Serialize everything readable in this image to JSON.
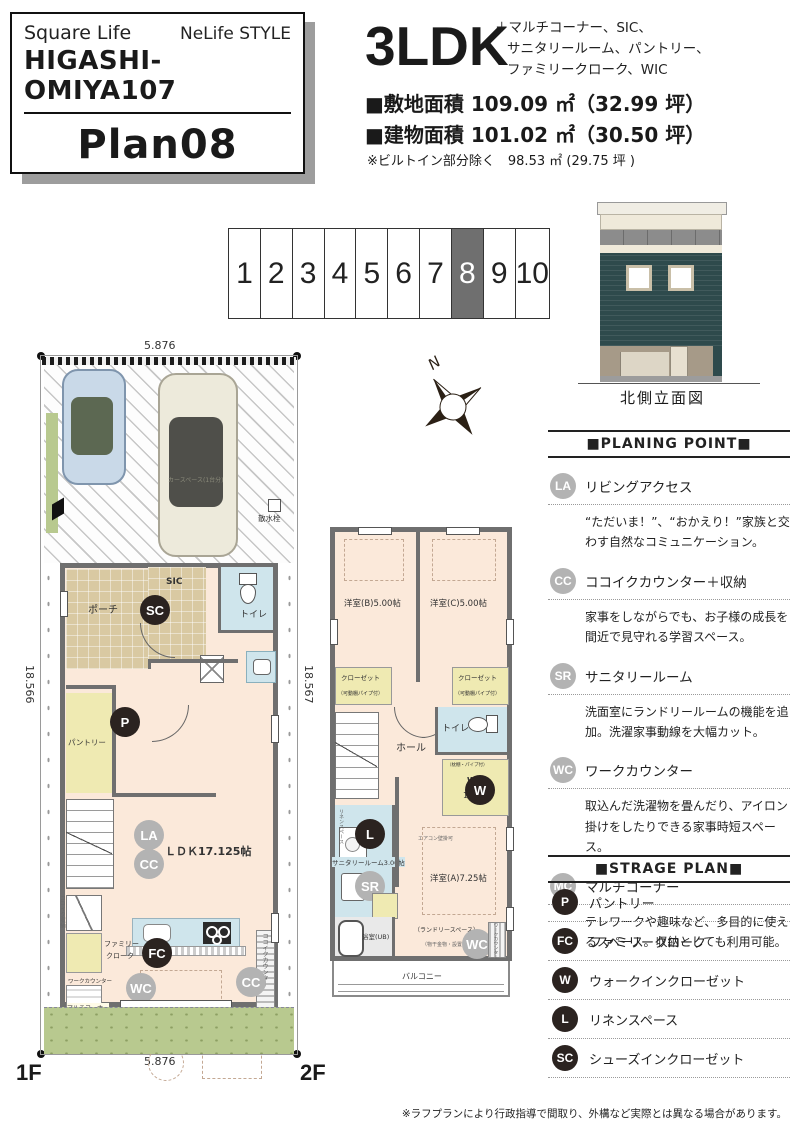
{
  "colors": {
    "badge_gray": "#b3b3b3",
    "badge_dark": "#2b2320",
    "wall_gray": "#6f6f6f",
    "room_cream": "#fbe9da",
    "closet_yellow": "#efeab2",
    "wet_blue": "#cfe5ec",
    "porch_tan": "#d9c9a2",
    "garden_green": "#b8c98f",
    "elevation_teal": "#2e4a4c",
    "lot_selected_bg": "#6f6f6f"
  },
  "header_card": {
    "brand": "Square Life",
    "style_name": "NeLife STYLE",
    "project": "HIGASHI-OMIYA107",
    "plan": "Plan08"
  },
  "summary": {
    "type": "3LDK",
    "features": [
      "＋マルチコーナー、SIC、",
      "サニタリールーム、パントリー、",
      "ファミリークローク、WIC"
    ],
    "site_area": "■敷地面積 109.09 ㎡（32.99 坪）",
    "building_area": "■建物面積 101.02 ㎡（30.50 坪）",
    "builtin_note": "※ビルトイン部分除く　98.53 ㎡ (29.75 坪 )"
  },
  "lot_strip": {
    "numbers": [
      "1",
      "2",
      "3",
      "4",
      "5",
      "6",
      "7",
      "8",
      "9",
      "10"
    ],
    "selected": "8"
  },
  "elevation": {
    "caption": "北側立面図"
  },
  "compass": {
    "label": "N"
  },
  "floor1": {
    "label": "1F",
    "dims": {
      "top": "5.876",
      "bottom": "5.876",
      "left": "18.566",
      "right": "18.567"
    },
    "labels": {
      "porch": "ポーチ",
      "sic": "SIC",
      "toilet": "トイレ",
      "hall": "ホール",
      "pantry": "パントリー",
      "ldk": "ＬＤＫ17.125帖",
      "kokoiku_counter": "ココイクカウンター",
      "kokoiku_storage": "ココイク収納",
      "family_cloak_1": "ファミリー",
      "family_cloak_2": "クローク",
      "work_counter": "ワークカウンター",
      "multi_corner": "マルチコーナー",
      "water_tap": "散水栓",
      "car_space": "カースペース(1台分)"
    },
    "badges": {
      "sc": "SC",
      "p": "P",
      "la": "LA",
      "cc1": "CC",
      "cc2": "CC",
      "fc": "FC",
      "wc": "WC",
      "mc": "MC"
    }
  },
  "floor2": {
    "label": "2F",
    "labels": {
      "bedroom_b": "洋室(B)5.00帖",
      "bedroom_c": "洋室(C)5.00帖",
      "closet": "クローゼット",
      "closet_note": "（可動棚パイプ付）",
      "toilet": "トイレ",
      "hall": "ホール",
      "wic": "WIC",
      "wic_size": "1.50帖",
      "wic_note": "（枕棚・パイプ付）",
      "bedroom_a": "洋室(A)7.25帖",
      "sanitary": "サニタリールーム3.00帖",
      "linen": "リネンスペース",
      "bath": "浴室(UB)",
      "balcony": "バルコニー",
      "laundry_space": "（ランドリースペース）",
      "laundry_note": "（物干金物・設置可）",
      "aircon_note": "エアコン壁掛可",
      "work_counter": "ワークカウンター"
    },
    "badges": {
      "w": "W",
      "l": "L",
      "sr": "SR",
      "wc": "WC"
    }
  },
  "planning_points": {
    "title": "■PLANING POINT■",
    "items": [
      {
        "badge": "LA",
        "title": "リビングアクセス",
        "desc": "“ただいま！”、“おかえり！”家族と交わす自然なコミュニケーション。"
      },
      {
        "badge": "CC",
        "title": "ココイクカウンター＋収納",
        "desc": "家事をしながらでも、お子様の成長を間近で見守れる学習スペース。"
      },
      {
        "badge": "SR",
        "title": "サニタリールーム",
        "desc": "洗面室にランドリールームの機能を追加。洗濯家事動線を大幅カット。"
      },
      {
        "badge": "WC",
        "title": "ワークカウンター",
        "desc": "取込んだ洗濯物を畳んだり、アイロン掛けをしたりできる家事時短スペース。"
      },
      {
        "badge": "MC",
        "title": "マルチコーナー",
        "desc": "テレワークや趣味など、多目的に使えるスペース。収納としても利用可能。"
      }
    ]
  },
  "storage_plan": {
    "title": "■STRAGE PLAN■",
    "items": [
      {
        "badge": "P",
        "label": "パントリー"
      },
      {
        "badge": "FC",
        "label": "ファミリークローク"
      },
      {
        "badge": "W",
        "label": "ウォークインクローゼット"
      },
      {
        "badge": "L",
        "label": "リネンスペース"
      },
      {
        "badge": "SC",
        "label": "シューズインクローゼット"
      }
    ]
  },
  "footer": {
    "disclaimer": "※ラフプランにより行政指導で間取り、外構など実際とは異なる場合があります。"
  }
}
